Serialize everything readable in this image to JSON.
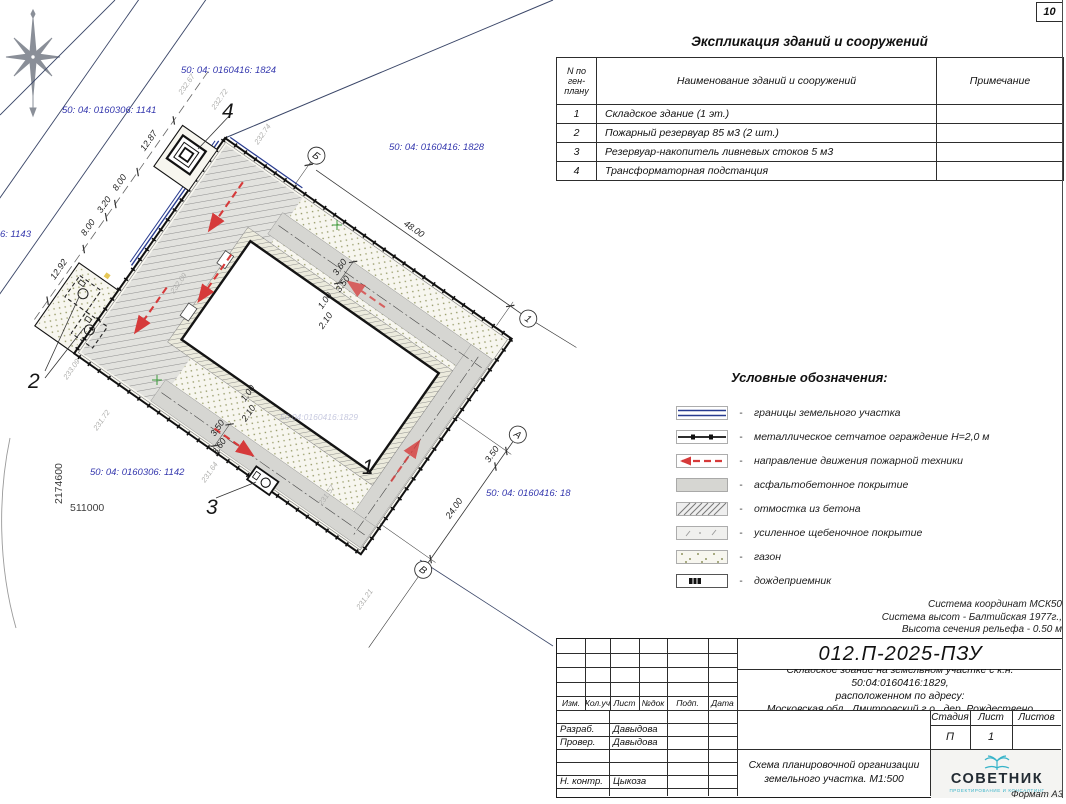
{
  "sheet": {
    "number": "10",
    "format": "Формат А3"
  },
  "survey_notes": {
    "line1": "Система координат МСК50",
    "line2": "Система высот - Балтийская 1977г.,",
    "line3": "Высота сечения рельефа - 0.50 м"
  },
  "explication": {
    "title": "Экспликация зданий и сооружений",
    "headers": {
      "num": "N по ген- плану",
      "name": "Наименование зданий и сооружений",
      "note": "Примечание"
    },
    "rows": [
      {
        "num": "1",
        "name": "Складское здание (1 эт.)",
        "note": ""
      },
      {
        "num": "2",
        "name": "Пожарный резервуар 85 м3 (2 шт.)",
        "note": ""
      },
      {
        "num": "3",
        "name": "Резервуар-накопитель ливневых стоков 5 м3",
        "note": ""
      },
      {
        "num": "4",
        "name": "Трансформаторная подстанция",
        "note": ""
      }
    ]
  },
  "legend": {
    "title": "Условные обозначения:",
    "items": [
      {
        "label": "границы земельного участка",
        "symbol": "parcel-boundary-double-line"
      },
      {
        "label": "металлическое сетчатое ограждение Н=2,0 м",
        "symbol": "mesh-fence-line"
      },
      {
        "label": "направление движения пожарной техники",
        "symbol": "fire-route-red-arrow"
      },
      {
        "label": "асфальтобетонное покрытие",
        "symbol": "asphalt-fill"
      },
      {
        "label": "отмостка из бетона",
        "symbol": "concrete-apron-hatch"
      },
      {
        "label": "усиленное щебеночное покрытие",
        "symbol": "gravel-fill"
      },
      {
        "label": "газон",
        "symbol": "lawn-dots"
      },
      {
        "label": "дождеприемник",
        "symbol": "storm-inlet"
      }
    ]
  },
  "title_block": {
    "doc_number": "012.П-2025-ПЗУ",
    "description_line1": "Складское здание на земельном участке с к.н. 50:04:0160416:1829,",
    "description_line2": "расположенном по адресу:",
    "description_line3": "Московская обл., Дмитровский г.о., дер. Рождествено",
    "columns": {
      "izm": "Изм.",
      "koluch": "Кол.уч",
      "list": "Лист",
      "ndok": "№док",
      "podp": "Подп.",
      "data": "Дата"
    },
    "stage_header": {
      "stage": "Стадия",
      "sheet": "Лист",
      "sheets": "Листов"
    },
    "stage_value": "П",
    "sheet_value": "1",
    "sheets_value": "",
    "roles": [
      {
        "role": "Разраб.",
        "name": "Давыдова"
      },
      {
        "role": "Провер.",
        "name": "Давыдова"
      },
      {
        "role": "Н. контр.",
        "name": "Цыкоза"
      }
    ],
    "drawing_title_line1": "Схема планировочной организации",
    "drawing_title_line2": "земельного участка. М1:500",
    "company": "СОВЕТНИК",
    "company_subtitle": "ПРОЕКТИРОВАНИЕ И КОНСАЛТИНГ"
  },
  "plan": {
    "cadastral": {
      "c1824": "50: 04: 0160416: 1824",
      "c1141": "50: 04: 0160306: 1141",
      "c1828": "50: 04: 0160416: 1828",
      "c1143": "6: 1143",
      "c1142": "50: 04: 0160306: 1142",
      "c18xx": "50: 04: 0160416: 18",
      "c1829_faint": "50:04:0160416:1829"
    },
    "coordinates": {
      "vertical": "2174600",
      "horizontal": "511000"
    },
    "buildings": {
      "b1": "1",
      "b2": "2",
      "b3": "3",
      "b4": "4"
    },
    "axes": {
      "top_start": "Б",
      "top_end": "1",
      "right_start": "А",
      "right_end": "В"
    },
    "dimensions": {
      "ne_edge": "48.00",
      "se_edge": "24.00",
      "se_offset": "3.50",
      "chain": [
        "12.87",
        "8.00",
        "3.20",
        "8.00",
        "12.92"
      ],
      "road_n": [
        "3.60",
        "3.50"
      ],
      "road_s": [
        "3.50",
        "3.60"
      ],
      "apron_n": [
        "1.00",
        "2.10"
      ],
      "apron_s": [
        "1.00",
        "2.10"
      ]
    },
    "elevations": [
      "232.67",
      "232.72",
      "232.74",
      "232.09",
      "233.09",
      "231.72",
      "231.64",
      "231.57",
      "231.21"
    ],
    "colors": {
      "cadastral_text": "#3538ae",
      "fire_route": "#d63a3a",
      "boundary_blue": "#283b8f",
      "grid_cross": "#3a9a3a"
    }
  }
}
